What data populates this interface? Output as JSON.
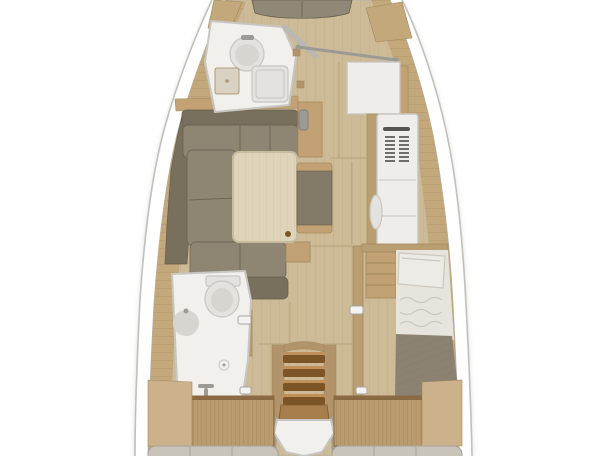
{
  "meta": {
    "title": "Sailboat interior layout plan",
    "view": "top-down floor plan rendering",
    "width_px": 608,
    "height_px": 456
  },
  "palette": {
    "hull_fill": "#ffffff",
    "hull_outline": "#c1c0bb",
    "inner_line": "#b3b1ac",
    "floor_base": "#cdbb97",
    "plank_line": "#b5a078",
    "deck_base": "#c3a87c",
    "deck_seam": "#a2885c",
    "seam_floor": "#b39e77",
    "vberth": "#8f8878",
    "sofa_seat": "#8e8673",
    "sofa_back": "#786f5d",
    "sofa_seam": "#665e4c",
    "wood_trim": "#c2a274",
    "wood_trim_stroke": "#a3885c",
    "table_top": "#ded4ba",
    "table_edge": "#c6bb9d",
    "table_grain": "#d2c7aa",
    "ottoman_body": "#837b68",
    "white_fixture": "#f1f0ec",
    "fixture_stroke": "#c7c6c1",
    "porcelain": "#e3e2de",
    "porcelain_deep": "#d6d5d0",
    "metal_gray": "#9b9a95",
    "door_gray": "#b9b8b3",
    "seat_pad": "#d9d2c2",
    "locker_white": "#eeede9",
    "grille_slat": "#6e6e68",
    "handle_dark": "#55544f",
    "wall_wood": "#b99e72",
    "latch_white": "#f4f3ef",
    "latch_stroke": "#a8a7a2",
    "sheet": "#e7e4de",
    "sheet_line": "#ccc8bf",
    "pillow": "#edebe6",
    "blanket": "#8b8272",
    "blanket_line": "#746c5e",
    "stair_rail": "#b3946a",
    "stair_light": "#c0905a",
    "stair_dark": "#7c5527",
    "stair_platform": "#a87f4c",
    "gray_flank": "#a59d8e",
    "panel_base": "#bb9c6f",
    "panel_stripe": "#8f7148",
    "panel_top": "#8a6a42",
    "stern_wood": "#ccb28a",
    "cushion_gray": "#c8c4ba",
    "cushion_stroke": "#a7a399"
  },
  "floorplan": {
    "type": "yacht-interior-floorplan",
    "areas": [
      {
        "name": "v-berth-cushion",
        "desc": "forward berth cushion at bow"
      },
      {
        "name": "forward-head",
        "desc": "forward bathroom: washbasin, shower tray, seat, open door"
      },
      {
        "name": "handrail",
        "desc": "grab rail beside forward head"
      },
      {
        "name": "storage-module",
        "desc": "white square storage module"
      },
      {
        "name": "tall-locker",
        "desc": "tall locker with vent grille and handle"
      },
      {
        "name": "saloon-sofa",
        "desc": "U-shaped saloon settee"
      },
      {
        "name": "saloon-table",
        "desc": "light wood saloon table"
      },
      {
        "name": "ottoman-bench",
        "desc": "upholstered bench with wood trim"
      },
      {
        "name": "mast-post",
        "desc": "mast compression post"
      },
      {
        "name": "aft-head",
        "desc": "aft bathroom: toilet, washbasin, shower drain"
      },
      {
        "name": "aft-cabin-bed",
        "desc": "aft cabin berth with pillow, sheets and blanket"
      },
      {
        "name": "companionway-stairs",
        "desc": "companionway steps with four treads"
      },
      {
        "name": "stern-berth-panels",
        "desc": "slatted berth panels at stern"
      },
      {
        "name": "stern-cushions",
        "desc": "grey cushions at stern edge"
      },
      {
        "name": "side-decks",
        "desc": "wood side decks along hull"
      }
    ]
  }
}
